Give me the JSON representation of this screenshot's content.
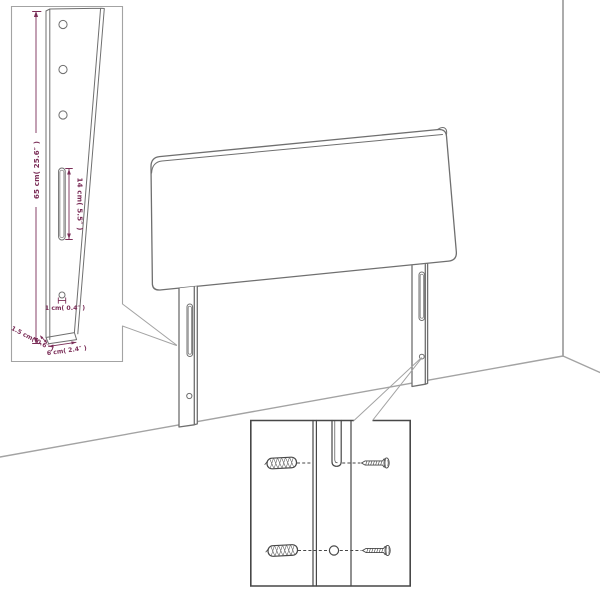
{
  "colors": {
    "background": "#ffffff",
    "line": "#6f6f6f",
    "line_dark": "#474747",
    "line_light": "#a3a3a3",
    "dimension": "#7b2e58"
  },
  "dimension_inset": {
    "height_label": "65 cm( 25.6″ )",
    "slot_height_label": "14 cm( 5.5″ )",
    "hole_diameter_label": "1 cm( 0.4″ )",
    "depth_label": "1.5 cm( 0.6″ )",
    "width_label": "6 cm( 2.4″ )"
  }
}
